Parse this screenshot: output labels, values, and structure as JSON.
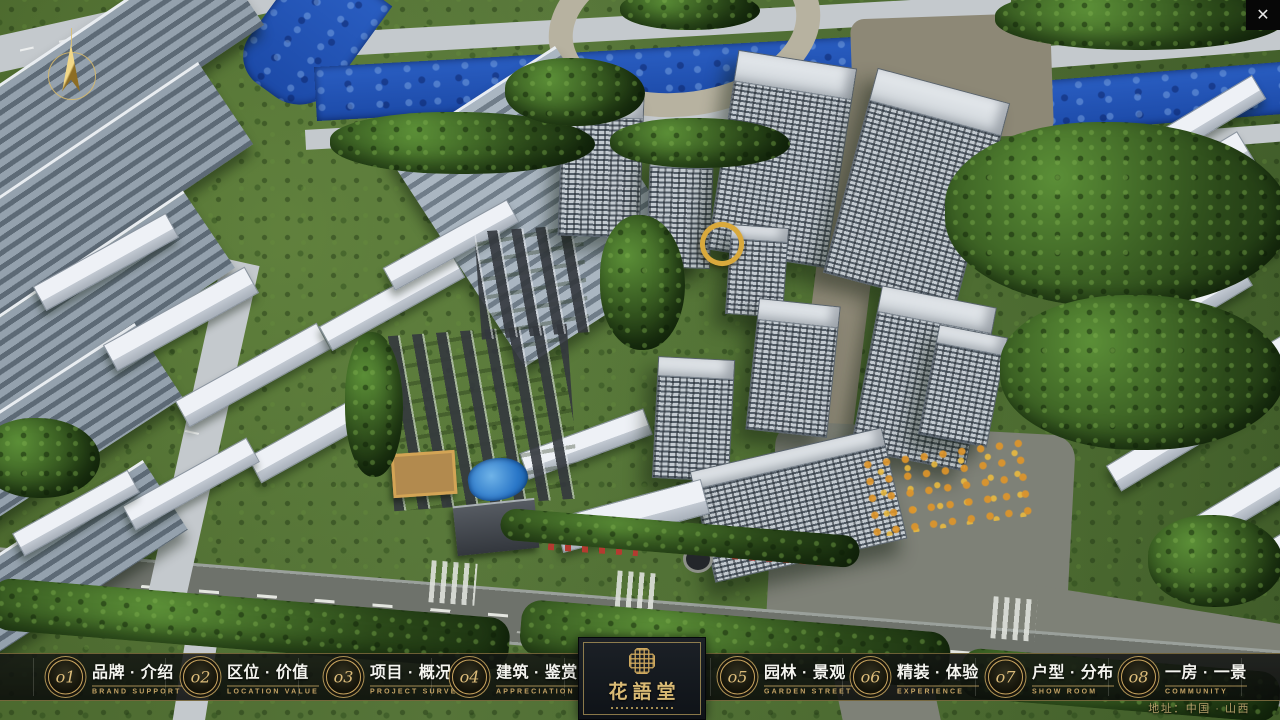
{
  "window": {
    "close_label": "✕"
  },
  "nav": {
    "items": [
      {
        "num": "o1",
        "title": "品牌 · 介绍",
        "subtitle": "BRAND SUPPORT"
      },
      {
        "num": "o2",
        "title": "区位 · 价值",
        "subtitle": "LOCATION VALUE"
      },
      {
        "num": "o3",
        "title": "项目 · 概况",
        "subtitle": "PROJECT SURVEY"
      },
      {
        "num": "o4",
        "title": "建筑 · 鉴赏",
        "subtitle": "APPRECIATION"
      },
      {
        "num": "o5",
        "title": "园林 · 景观",
        "subtitle": "GARDEN STREET"
      },
      {
        "num": "o6",
        "title": "精装 · 体验",
        "subtitle": "EXPERIENCE"
      },
      {
        "num": "o7",
        "title": "户型 · 分布",
        "subtitle": "SHOW ROOM"
      },
      {
        "num": "o8",
        "title": "一房 · 一景",
        "subtitle": "COMMUNITY"
      }
    ]
  },
  "logo": {
    "name": "花語堂"
  },
  "footer": {
    "address": "地址：中国 · 山西"
  },
  "colors": {
    "gold_accent": "#c9a55f",
    "bar_background": "#121412",
    "title_text": "#f4f4ef",
    "river_blue": "#2a5ec2",
    "grass_green": "#4a6830",
    "road_gray": "#6e726b"
  }
}
